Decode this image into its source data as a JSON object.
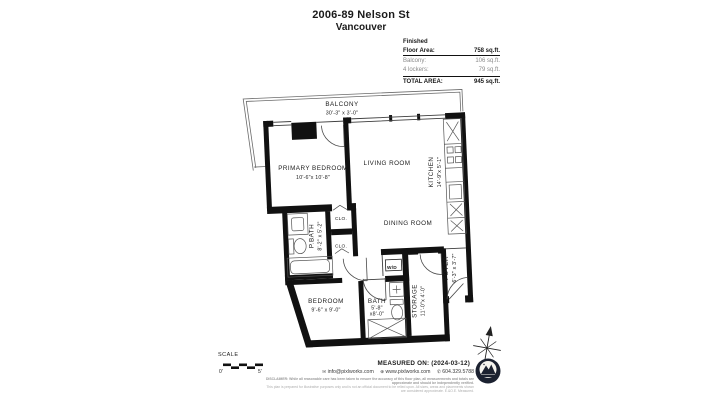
{
  "title": {
    "line1": "2006-89 Nelson St",
    "line2": "Vancouver"
  },
  "area_table": {
    "finished_label": "Finished",
    "floor_area_label": "Floor Area:",
    "floor_area_value": "758 sq.ft.",
    "balcony_label": "Balcony:",
    "balcony_value": "106 sq.ft.",
    "lockers_label": "4 lockers:",
    "lockers_value": "79 sq.ft.",
    "total_label": "TOTAL AREA:",
    "total_value": "945 sq.ft."
  },
  "rooms": {
    "balcony": {
      "name": "BALCONY",
      "dims": "30'-3\" x 3'-0\""
    },
    "primary_bedroom": {
      "name": "PRIMARY BEDROOM",
      "dims": "10'-6\"x 10'-8\""
    },
    "living_room": {
      "name": "LIVING ROOM"
    },
    "kitchen": {
      "name": "KITCHEN",
      "dims": "14'-9\"x 5'-1\""
    },
    "dining_room": {
      "name": "DINING ROOM"
    },
    "pbath": {
      "name": "P.BATH",
      "dims": "8'-2\" x 5'-2\""
    },
    "closet1": {
      "name": "CLO."
    },
    "closet2": {
      "name": "CLO."
    },
    "bedroom": {
      "name": "BEDROOM",
      "dims": "9'-6\" x 9'-0\""
    },
    "bath": {
      "name": "BATH",
      "dims_l1": "5'-8\"",
      "dims_l2": "x8'-0\""
    },
    "wd": {
      "name": "W/D"
    },
    "storage": {
      "name": "STORAGE",
      "dims": "11'-0\"x 4'-0\""
    },
    "foyer": {
      "name": "FOYER",
      "dims": "6'-3\" x 3'-7\""
    }
  },
  "footer": {
    "scale_label": "SCALE",
    "scale_start": "0'",
    "scale_end": "5'",
    "measured_on": "MEASURED ON: (2024-03-12)",
    "email": "info@pixlworks.com",
    "website": "www.pixlworks.com",
    "phone": "604.329.5788",
    "disclaimer_line1": "DISCLAIMER: While all reasonable care has been taken to ensure the accuracy of this floor plan, all measurements and totals are approximate and should be independently verified.",
    "disclaimer_line2": "This plan is prepared for illustrative purposes only and is not an official document to be relied upon. All sizes, areas and placements shown are considered approximate. E.&O.E. Measured."
  },
  "colors": {
    "wall": "#111111",
    "thin_line": "#3d3d3d",
    "accent_dark": "#1b2130",
    "muted_text": "#8a8a8a"
  }
}
